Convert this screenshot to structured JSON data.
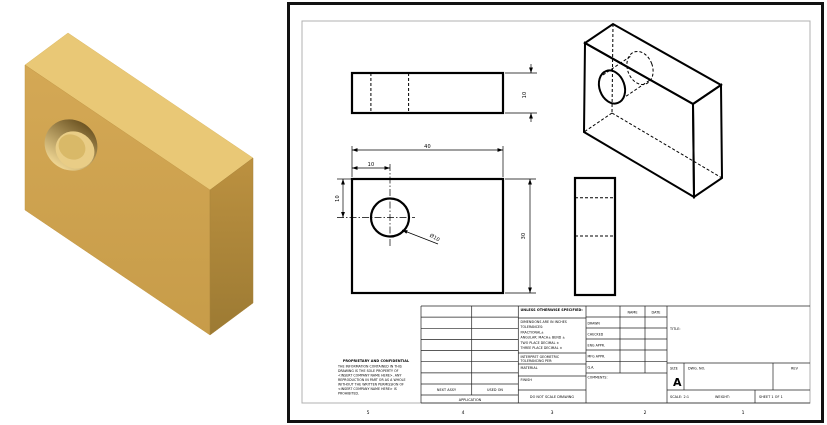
{
  "left_view": {
    "part_name": "block-with-hole-3d-model",
    "colors": {
      "top_face": "#E9C876",
      "front_face": "#D0A452",
      "side_face_top": "#BC9140",
      "side_face_bottom": "#9C7A33",
      "hole_shadow": "#6E5523",
      "hole_light": "#EFD693"
    }
  },
  "drawing_sheet": {
    "dimensions": {
      "depth": "10",
      "width": "40",
      "hole_offset_x": "10",
      "hole_offset_y": "10",
      "hole_diameter": "Ø10",
      "height": "30"
    },
    "zone_labels": [
      "5",
      "4",
      "3",
      "2",
      "1"
    ],
    "title_block": {
      "proprietary_title": "PROPRIETARY AND CONFIDENTIAL",
      "proprietary_lines": [
        "THE INFORMATION CONTAINED IN THIS",
        "DRAWING IS THE SOLE PROPERTY OF",
        "<INSERT COMPANY NAME HERE>. ANY",
        "REPRODUCTION IN PART OR AS A WHOLE",
        "WITHOUT THE WRITTEN PERMISSION OF",
        "<INSERT COMPANY NAME HERE> IS",
        "PROHIBITED."
      ],
      "next_assy": "NEXT ASSY",
      "used_on": "USED ON",
      "application": "APPLICATION",
      "unless": "UNLESS OTHERWISE SPECIFIED:",
      "tol_lines": [
        "DIMENSIONS ARE IN INCHES",
        "TOLERANCES:",
        "FRACTIONAL±",
        "ANGULAR: MACH±  BEND ±",
        "TWO PLACE DECIMAL    ±",
        "THREE PLACE DECIMAL  ±"
      ],
      "interpret_line1": "INTERPRET GEOMETRIC",
      "interpret_line2": "TOLERANCING PER:",
      "material": "MATERIAL",
      "finish": "FINISH",
      "do_not_scale": "DO NOT SCALE DRAWING",
      "name_header": "NAME",
      "date_header": "DATE",
      "rows": [
        "DRAWN",
        "CHECKED",
        "ENG APPR.",
        "MFG APPR.",
        "Q.A.",
        "COMMENTS:"
      ],
      "title_label": "TITLE:",
      "size_label": "SIZE",
      "size_value": "A",
      "dwg_no_label": "DWG. NO.",
      "rev_label": "REV",
      "scale_text": "SCALE: 2:1",
      "weight_text": "WEIGHT:",
      "sheet_text": "SHEET 1 OF 1"
    }
  }
}
